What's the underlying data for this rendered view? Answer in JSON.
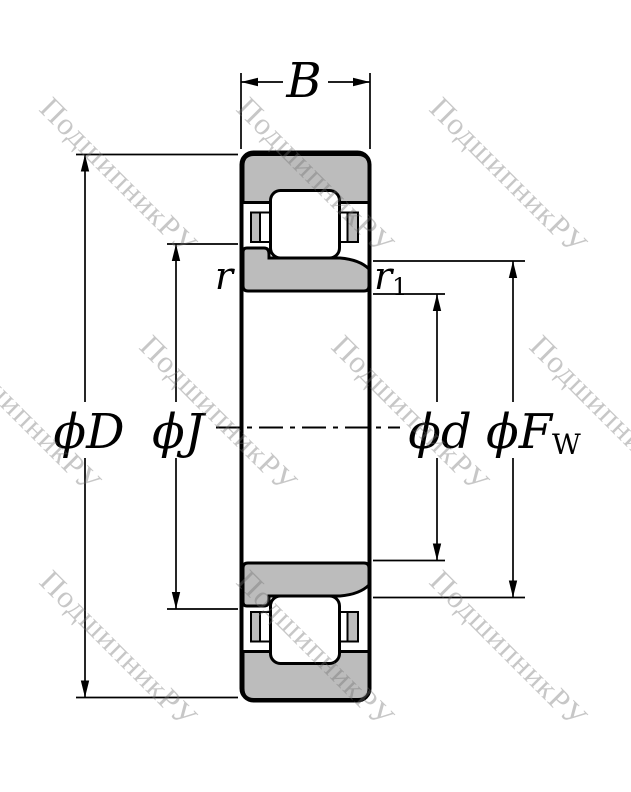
{
  "watermark": {
    "text": "ПодшипникРУ"
  },
  "dimensions": {
    "width_label": "B",
    "outer_dia_label": "ϕD",
    "flange_dia_label": "ϕJ",
    "bore_dia_label": "ϕd",
    "raceway_dia_main": "ϕF",
    "raceway_dia_sub": "W",
    "outer_chamfer_label": "r",
    "inner_chamfer_main": "r",
    "inner_chamfer_sub": "1"
  },
  "colors": {
    "ring_fill": "#bcbcbc",
    "outline": "#000000",
    "background": "#ffffff",
    "watermark": "#6e6e6e"
  }
}
